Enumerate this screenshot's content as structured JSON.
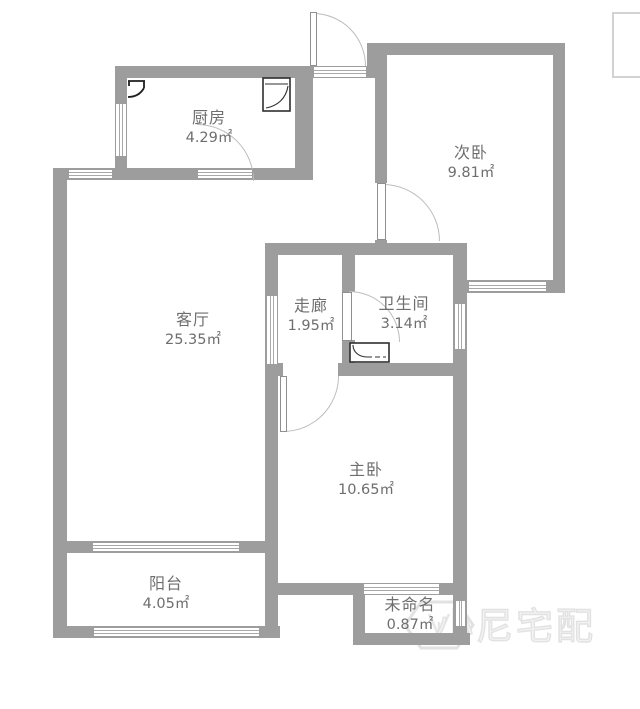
{
  "floorplan": {
    "rooms": [
      {
        "id": "kitchen",
        "name": "厨房",
        "area": "4.29㎡"
      },
      {
        "id": "second-bedroom",
        "name": "次卧",
        "area": "9.81㎡"
      },
      {
        "id": "living-room",
        "name": "客厅",
        "area": "25.35㎡"
      },
      {
        "id": "corridor",
        "name": "走廊",
        "area": "1.95㎡"
      },
      {
        "id": "bathroom",
        "name": "卫生间",
        "area": "3.14㎡"
      },
      {
        "id": "master-bedroom",
        "name": "主卧",
        "area": "10.65㎡"
      },
      {
        "id": "balcony",
        "name": "阳台",
        "area": "4.05㎡"
      },
      {
        "id": "unnamed",
        "name": "未命名",
        "area": "0.87㎡"
      }
    ],
    "watermark": {
      "text": "小尼宅配"
    },
    "colors": {
      "wall": "#9d9d9d",
      "label_text": "#6e6e6e",
      "watermark": "#e2e2e2",
      "fixture_line": "#2f2f2f"
    }
  }
}
